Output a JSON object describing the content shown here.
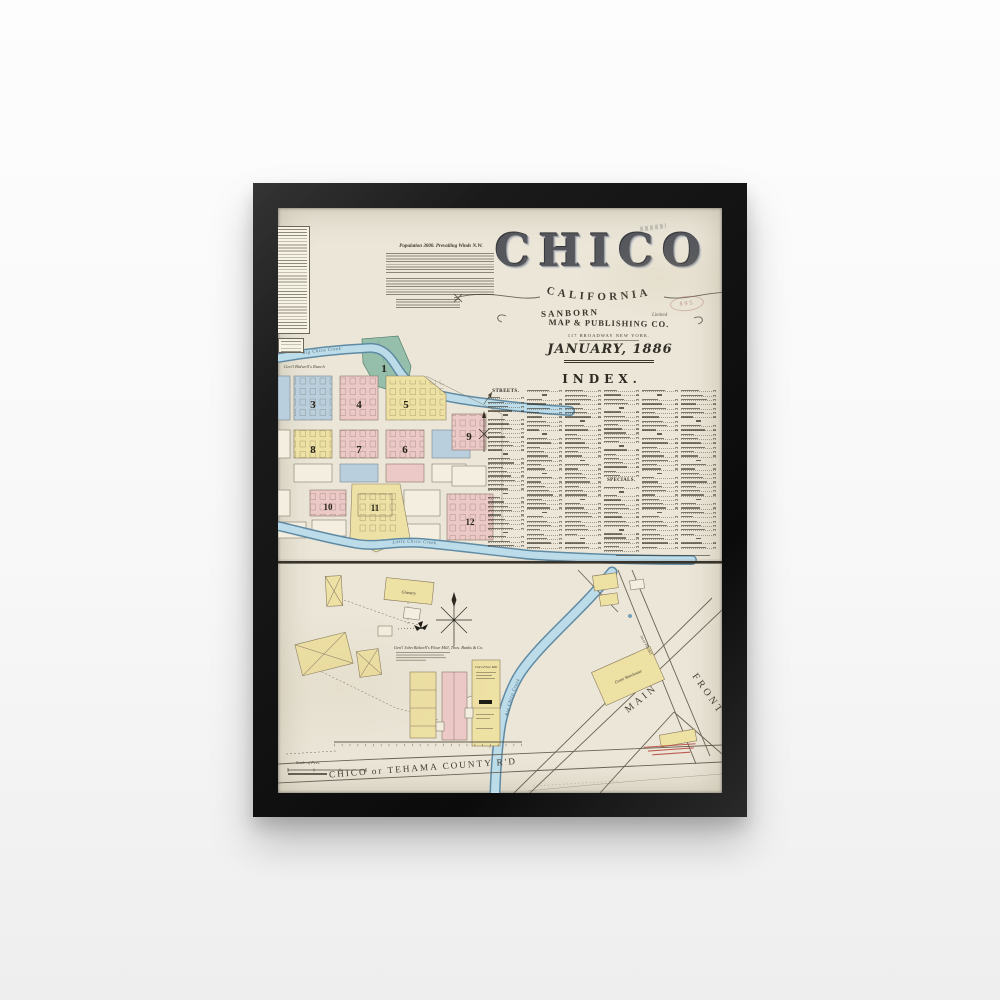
{
  "palette": {
    "frame": "#141414",
    "paper": "#ebe6d8",
    "ink": "#3c372e",
    "pink": "#ecc9c7",
    "yellow": "#eee1a4",
    "blue": "#b9cfdd",
    "green": "#96bfab",
    "creekfill": "#bddcea",
    "creekedge": "#5f8aa3",
    "rednote": "#b5443a"
  },
  "header": {
    "title": "CHICO",
    "subtitle": "CALIFORNIA",
    "publisher_line1": "SANBORN",
    "publisher_line2": "MAP & PUBLISHING CO.",
    "publisher_limited": "Limited",
    "address": "117 BROADWAY NEW YORK.",
    "date": "JANUARY, 1886",
    "stamp": "895"
  },
  "notes": {
    "title": "Population 3000. Prevailing Winds N.W."
  },
  "index": {
    "title": "INDEX.",
    "streets_label": "STREETS.",
    "specials_label": "SPECIALS.",
    "columns": 6,
    "rows_per_column": 37,
    "specials_column": 4,
    "specials_after_row": 21
  },
  "top_map": {
    "ranch_label": "Gen'l Bidwell's Ranch",
    "creek1_label": "Big Chico Creek",
    "creek2_label": "Little Chico Creek",
    "blocks": [
      {
        "num": "1"
      },
      {
        "num": "3"
      },
      {
        "num": "4"
      },
      {
        "num": "5"
      },
      {
        "num": "6"
      },
      {
        "num": "7"
      },
      {
        "num": "8"
      },
      {
        "num": "9"
      },
      {
        "num": "10"
      },
      {
        "num": "11"
      },
      {
        "num": "12"
      }
    ]
  },
  "bottom_map": {
    "mill_title": "Gen'l John Bidwell's Flour Mill, Thos. Banks & Co.",
    "granary_label": "Granary",
    "flour_mill_label": "Chico Flour Mill",
    "warehouse_label": "Grain Warehouse",
    "creek_label": "Big Chico Creek",
    "road_label": "CHICO  or  TEHAMA   COUNTY   R'D",
    "street_main": "MAIN",
    "street_front": "FRONT",
    "street_1st": "1st or FRONT",
    "scale_label": "Scale of Feet."
  }
}
